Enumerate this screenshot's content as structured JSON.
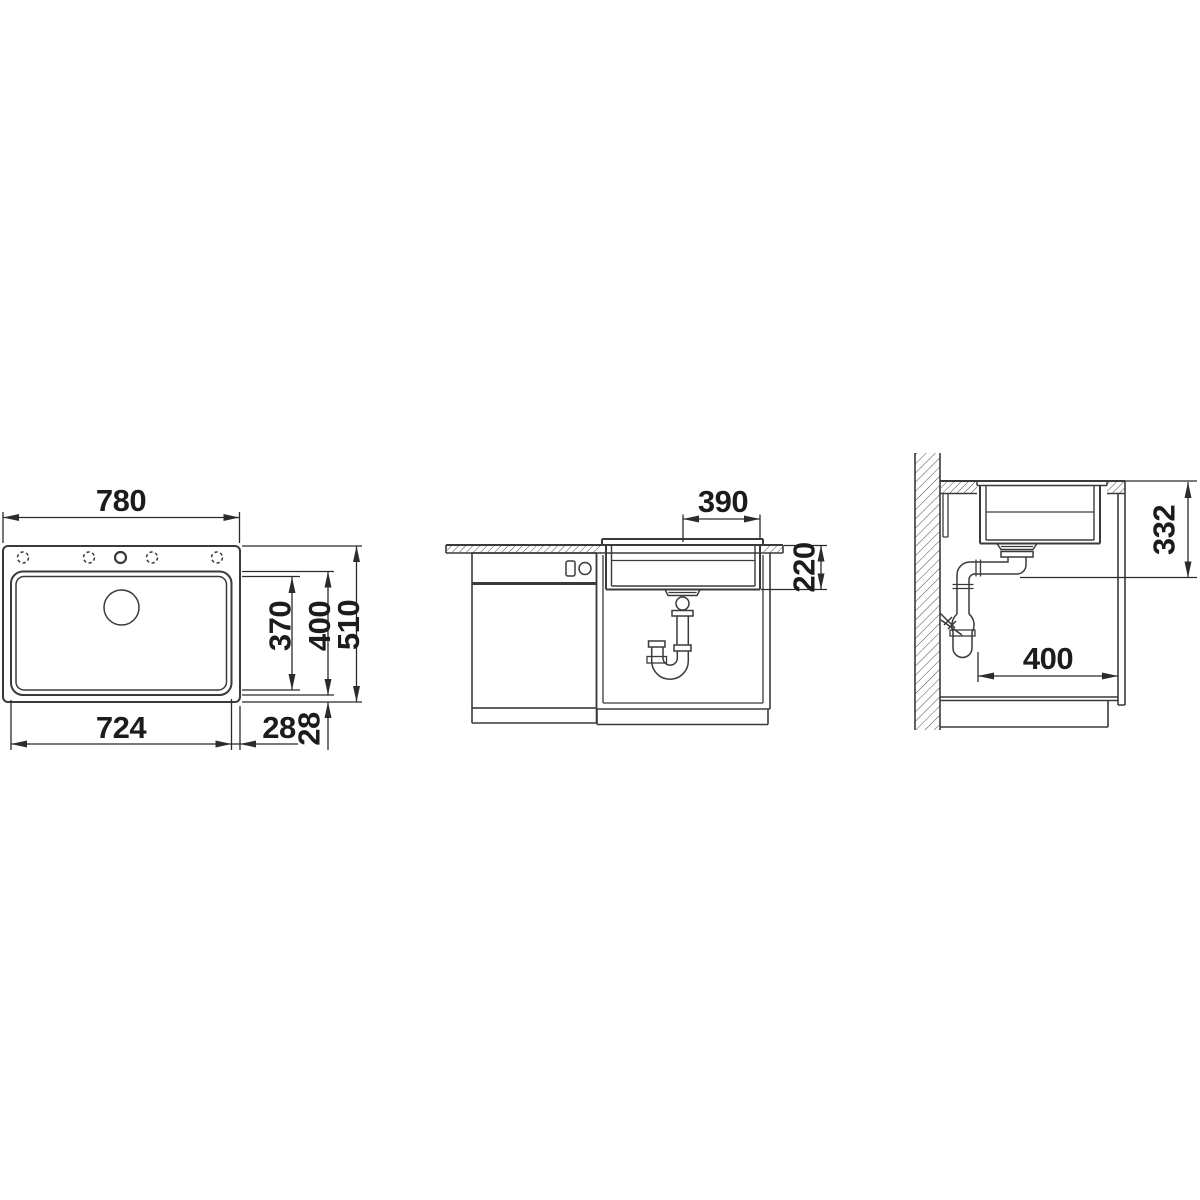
{
  "colors": {
    "background": "#ffffff",
    "line": "#3a3a3a",
    "dimension_line": "#2b2b2b",
    "label_text": "#1c1c1c"
  },
  "drawing_type": "kitchen sink installation dimension drawing (3 orthographic views)",
  "views": {
    "top_view": {
      "dims": {
        "total_width": "780",
        "bowl_width": "724",
        "rim_side": "28",
        "rim_front": "28",
        "bowl_inner_length": "370",
        "bowl_outer_length": "400",
        "total_length": "510"
      }
    },
    "front_view": {
      "dims": {
        "center_to_edge": "390",
        "bowl_depth": "220"
      }
    },
    "side_view": {
      "dims": {
        "height_below_worktop": "332",
        "cabinet_clearance": "400"
      }
    }
  }
}
